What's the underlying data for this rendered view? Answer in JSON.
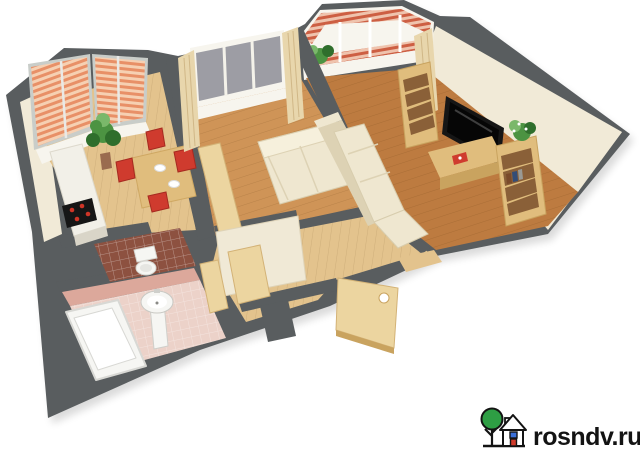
{
  "watermark": {
    "text": "rosndv.ru"
  },
  "colors": {
    "bg": "#ffffff",
    "wall": "#595d5f",
    "wall-face": "#f1ead7",
    "white": "#f7f5ee",
    "floor-light": "#e3c38d",
    "floor-mid": "#cf9457",
    "floor-dark": "#bd7b40",
    "blind-a": "#e89067",
    "blind-b": "#f6d0b2",
    "frame-gray": "#c9cdc9",
    "brick-a": "#cd5f43",
    "brick-b": "#efc3ad",
    "glass": "#9d9da4",
    "curtain": "#e8d6ac",
    "curtain-fold": "#d0b787",
    "wood-light": "#ecd5a0",
    "wood-mid": "#e0bd7d",
    "wood-dark": "#c9a35f",
    "shelf-slot": "#8a6038",
    "sofa-cream": "#efe7d0",
    "sofa-shadow": "#ddd2b4",
    "chair-red": "#cf3b2e",
    "tv-black": "#161616",
    "tile-pink": "#dca89b",
    "tile-pink-floor": "#ecd2c9",
    "tile-brown": "#8d5140",
    "porcelain": "#f6f6f3",
    "pot-brown": "#9a6b4f",
    "plant-green": "#4c9342",
    "plant-dark": "#2f6e2c",
    "plant-light": "#7ab86a",
    "logo-green": "#2e9e44",
    "logo-blue": "#3a6fd8",
    "logo-red": "#d03a2a",
    "ink": "#131313"
  },
  "scene": {
    "description": "3D isometric floor plan render of a two-room apartment, viewed from above at an angle on a white background",
    "rooms": [
      {
        "name": "kitchen",
        "features": [
          "bay-window-with-orange-blinds",
          "potted-plant",
          "dining-table",
          "four-red-chairs",
          "white-counter",
          "black-cooktop-with-red-burners"
        ]
      },
      {
        "name": "bedroom",
        "features": [
          "window-with-beige-curtains",
          "cream-sofa",
          "wood-sideboard",
          "wardrobe"
        ]
      },
      {
        "name": "living-room",
        "features": [
          "balcony-with-brick-striped-rails",
          "wall-mounted-tv",
          "two-wood-bookshelves",
          "tv-stand-with-red-magazine",
          "corner-sofa",
          "plant-on-shelf",
          "curtain"
        ]
      },
      {
        "name": "hallway",
        "features": [
          "closet-block",
          "two-open-wood-doors",
          "open-entrance-door-with-round-hole"
        ]
      },
      {
        "name": "bathroom",
        "features": [
          "pink-tiles",
          "bathtub",
          "pedestal-sink"
        ]
      },
      {
        "name": "wc",
        "features": [
          "brown-tiles",
          "toilet"
        ]
      }
    ]
  }
}
